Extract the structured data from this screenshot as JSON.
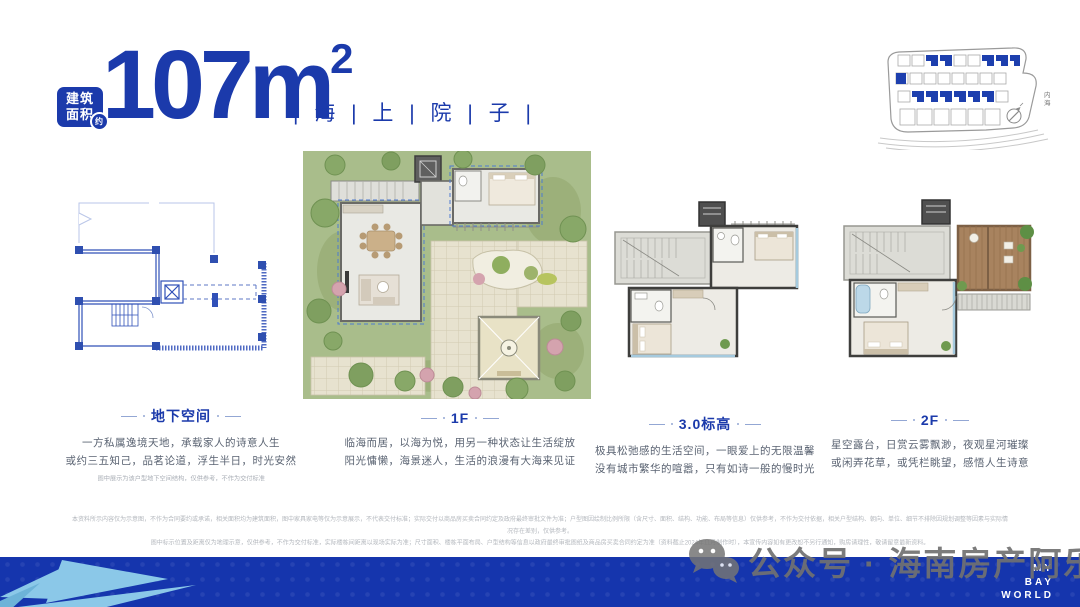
{
  "header": {
    "badge_line1": "建筑",
    "badge_line2": "面积",
    "badge_approx": "约",
    "area_value": "107m",
    "area_sup": "2",
    "project_name": "| 海 | 上 | 院 | 子 |"
  },
  "site_plan": {
    "sea_label": "内海"
  },
  "sections": [
    {
      "title": "地下空间",
      "desc1": "一方私属逸境天地，承载家人的诗意人生",
      "desc2": "或约三五知己，品茗论道，浮生半日，时光安然",
      "note": "图中展示为该户型地下空间结构，仅供参考，不作为交付标准"
    },
    {
      "title": "1F",
      "desc1": "临海而居，以海为悦，用另一种状态让生活绽放",
      "desc2": "阳光慵懒，海景迷人，生活的浪漫有大海来见证"
    },
    {
      "title": "3.0标高",
      "desc1": "极具松弛感的生活空间，一眼爱上的无限温馨",
      "desc2": "没有城市繁华的喧嚣，只有如诗一般的慢时光"
    },
    {
      "title": "2F",
      "desc1": "星空露台，日赏云雾飘渺，夜观星河璀璨",
      "desc2": "或闲弄花草，或凭栏眺望，感悟人生诗意"
    }
  ],
  "disclaimer": {
    "line1": "本资料所示内容仅为示意图，不作为合同要约或承诺，相关面积均为建筑面积，图中家具家电等仅为示意展示，不代表交付标准；实际交付以商品房买卖合同约定及政府最终审批文件为准；户型图因绘制比例所限（含尺寸、面积、结构、功能、布局等信息）仅供参考，不作为交付依据，相关户型结构、朝向、单位、细节不排除因规划调整等因素与实际情况存在差别，仅供参考。",
    "line2": "图中标示位置及距离仅为地理示意，仅供参考，不作为交付标准，实际楼栋间距离以现场实际为准；尺寸面积、楼栋平面布局、户型结构等信息以政府最终审批图纸及商品房买卖合同约定为准（资料截止2024年11月制作时），本宣传内容如有更改恕不另行通知，购房请理性，敬请留意最新资料。"
  },
  "watermark": {
    "text": "公众号 · 海南房产阿乐"
  },
  "footer": {
    "brand_line1": "MY",
    "brand_line2": "BAY",
    "brand_line3": "WORLD"
  },
  "colors": {
    "brand_blue": "#1b3aab",
    "bar_blue": "#1535ad",
    "light_blue": "#8bc8e8",
    "plan_line_blue": "#3050b8",
    "lawn_green": "#a9bd8b"
  }
}
